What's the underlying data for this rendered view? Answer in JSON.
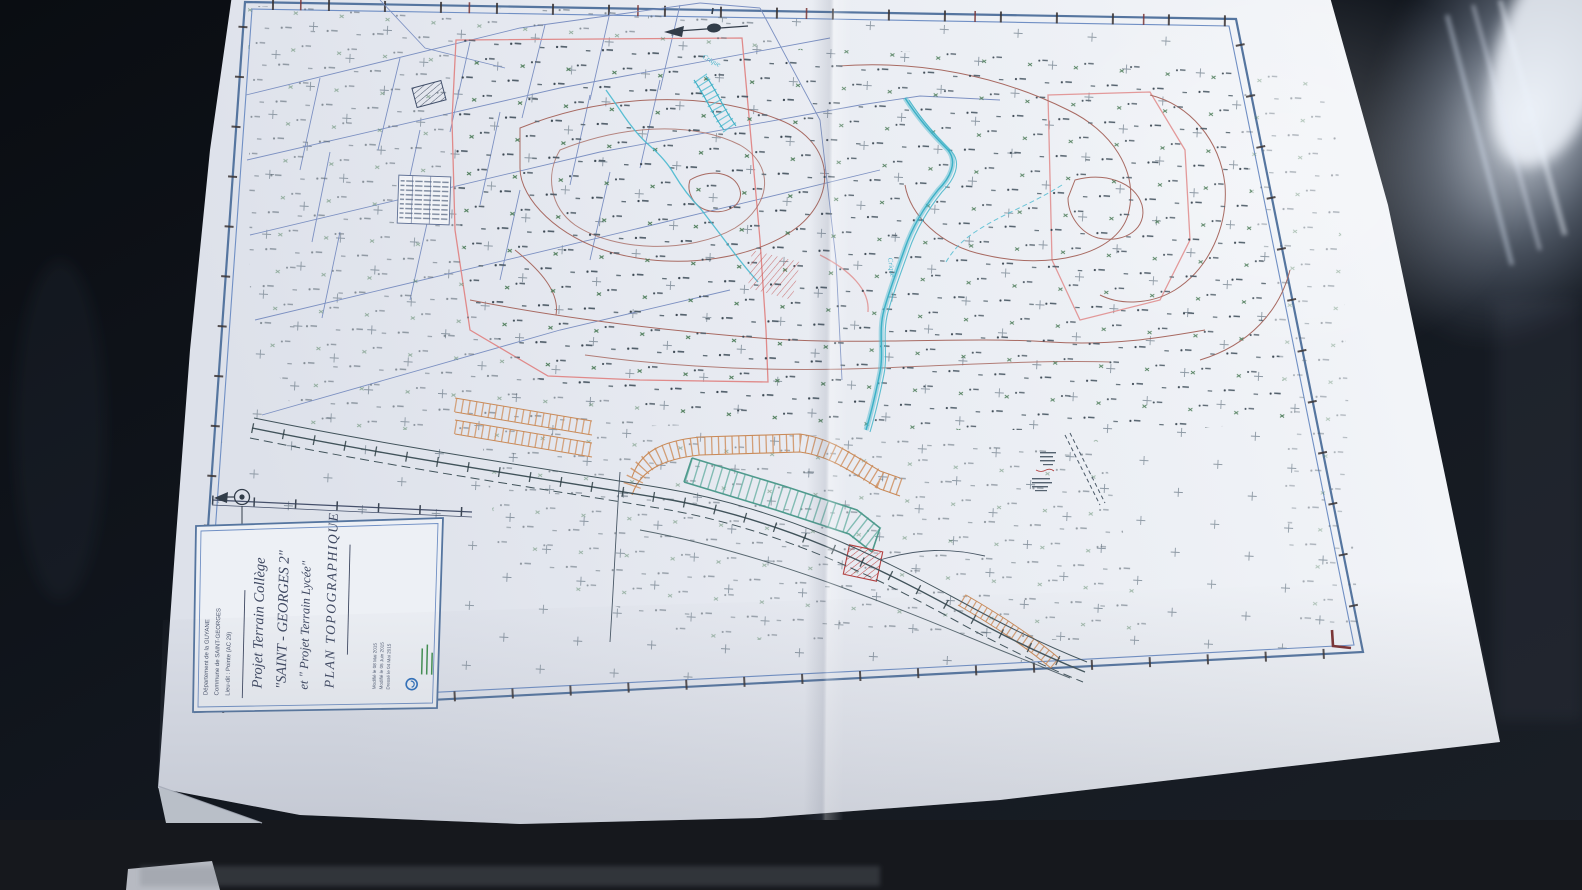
{
  "title_block": {
    "department": "Département de la GUYANE",
    "commune": "Commune de SAINT-GEORGES",
    "lieu_dit": "Lieu-dit : Pointe (AC 29)",
    "title_line1": "Projet Terrain Collège",
    "title_line2": "\"SAINT - GEORGES 2\"",
    "title_line3": "et \" Projet Terrain Lycée\"",
    "title_line4": "PLAN TOPOGRAPHIQUE",
    "date_line1": "Modifié le 08 Mai 2015",
    "date_line2": "Modifié le 05 Juin 2015",
    "date_line3": "Dressé le 04 Mai 2015"
  },
  "map_labels": {
    "creek_upper": "Crique",
    "creek_main": "Crique"
  },
  "colors": {
    "paper": "#eef0f5",
    "frame_blue": "#54749f",
    "contour_brown": "#a86a62",
    "survey_pink": "#e08a8a",
    "water_cyan": "#45b8cc",
    "embankment_orange": "#cf9160",
    "platform_teal": "#57a899",
    "road_dark": "#41525a",
    "parcel_blue": "#7d91c2",
    "corner_mark_red": "#7a3030",
    "ink_blue": "#3d4660",
    "background_dark": "#12161c"
  }
}
